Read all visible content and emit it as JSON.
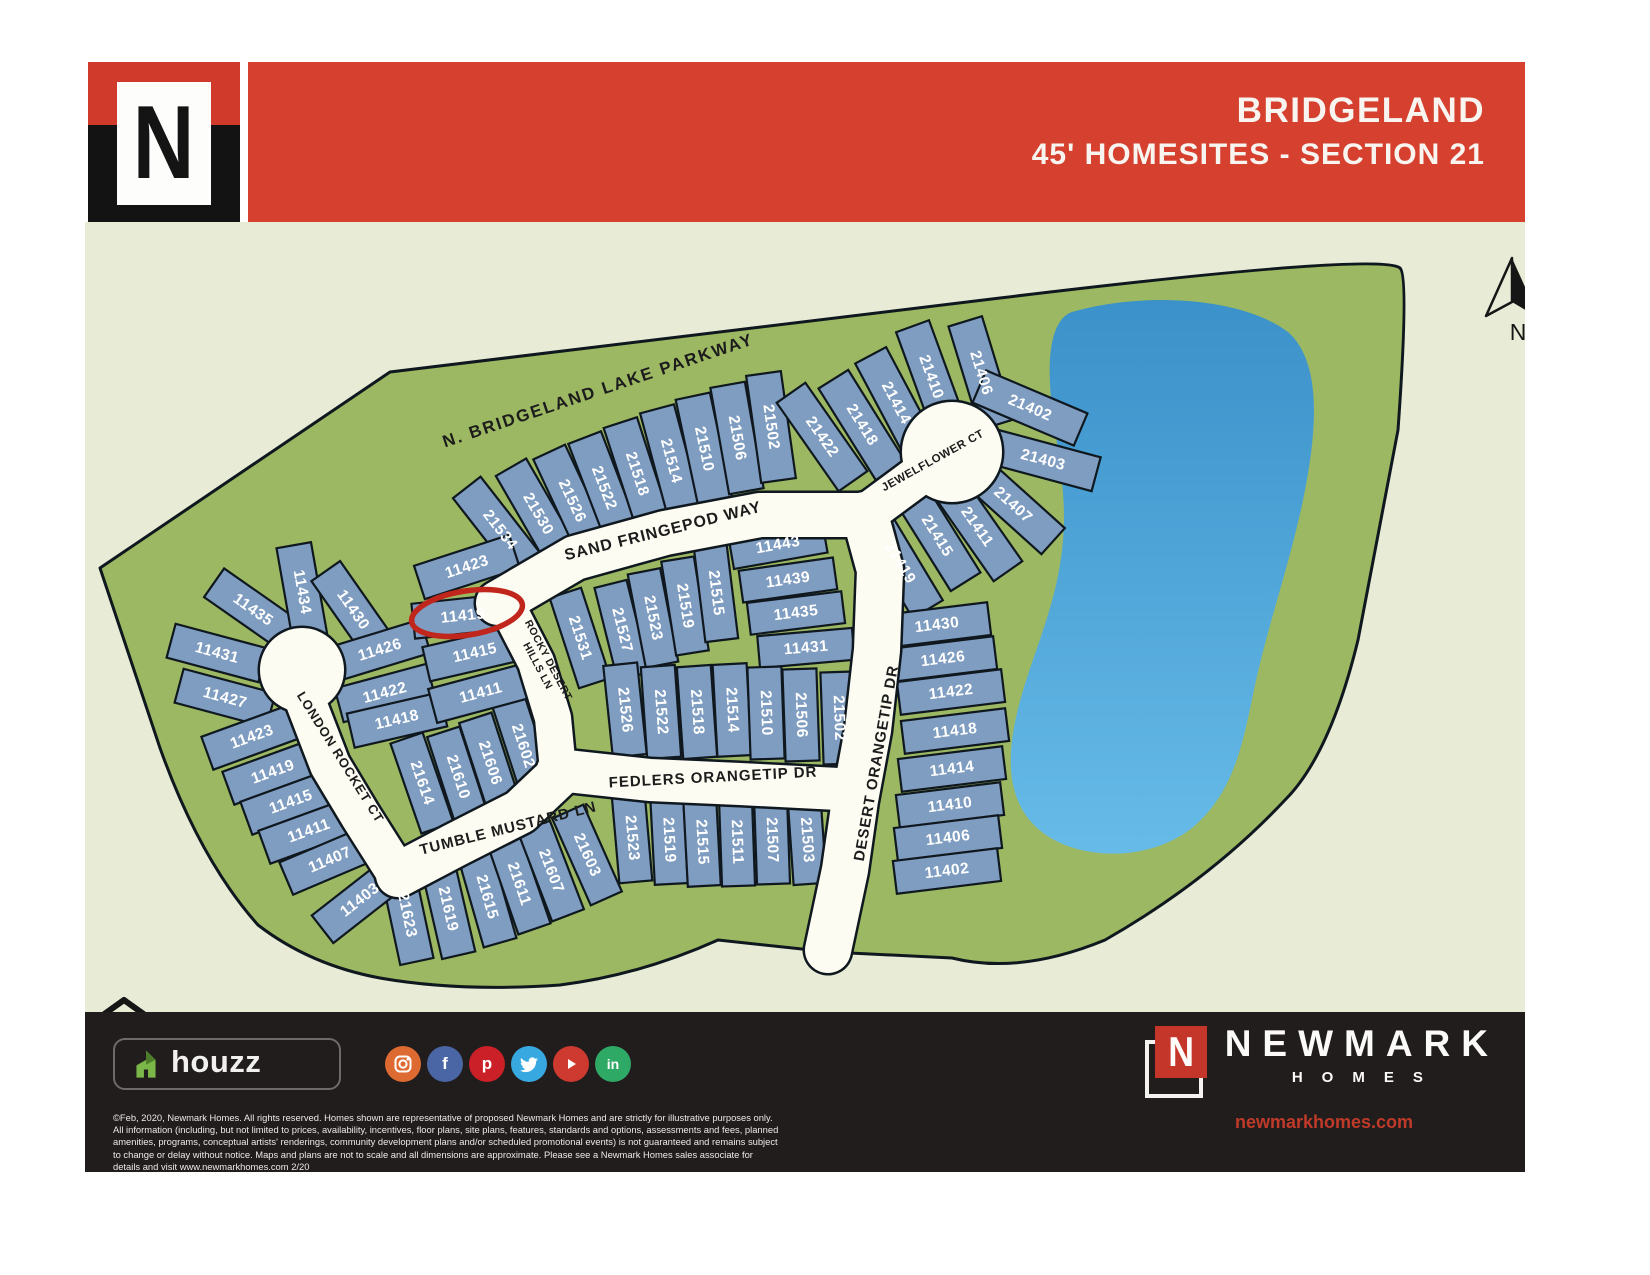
{
  "header": {
    "title_line1": "BRIDGELAND",
    "title_line2": "45' HOMESITES -  SECTION 21",
    "logo_letter": "N",
    "band_color": "#d6402e"
  },
  "map": {
    "colors": {
      "background": "#e8ebd6",
      "land": "#9cb862",
      "lake_top": "#3b91c9",
      "lake_bottom": "#66bbe8",
      "lot": "#7f9dc1",
      "road": "#fcfcf2",
      "outline": "#10181f",
      "street_text": "#1c1c1c",
      "lot_text": "#ffffff",
      "highlight": "#c1261d"
    },
    "land_path": "M 100,568 L 390,372 L 1000,298 Q 1380,252 1400,268 Q 1409,276 1398,430 L 1358,640 Q 1330,755 1285,800 Q 1210,880 1105,940 Q 1020,975 952,958 L 830,952 L 718,940 Q 640,975 560,985 Q 460,992 380,978 Q 310,965 258,925 Q 200,860 160,748 Z",
    "lake_path": "M 1072,312 C 1140,292 1240,296 1288,332 C 1322,362 1318,430 1302,505 C 1287,573 1268,625 1255,685 C 1243,742 1235,792 1192,828 C 1148,863 1072,862 1035,826 C 1002,794 1008,742 1022,694 C 1038,640 1058,600 1063,540 C 1068,482 1052,430 1050,384 C 1048,344 1055,318 1072,312 Z",
    "roads": [
      {
        "name": "sand-fringepod-way",
        "pts": [
          [
            498,
            603
          ],
          [
            575,
            558
          ],
          [
            665,
            533
          ],
          [
            760,
            515
          ],
          [
            865,
            515
          ]
        ],
        "w": 44
      },
      {
        "name": "jewelflower-ct-stem",
        "pts": [
          [
            865,
            515
          ],
          [
            915,
            478
          ],
          [
            940,
            462
          ]
        ],
        "w": 40
      },
      {
        "name": "desert-orangetip-dr",
        "pts": [
          [
            865,
            515
          ],
          [
            880,
            570
          ],
          [
            877,
            650
          ],
          [
            868,
            730
          ],
          [
            855,
            800
          ],
          [
            845,
            870
          ],
          [
            828,
            950
          ]
        ],
        "w": 46
      },
      {
        "name": "fedlers-orangetip-dr",
        "pts": [
          [
            558,
            770
          ],
          [
            650,
            780
          ],
          [
            740,
            784
          ],
          [
            858,
            790
          ]
        ],
        "w": 42
      },
      {
        "name": "rocky-desert-hills-ln",
        "pts": [
          [
            506,
            604
          ],
          [
            536,
            662
          ],
          [
            553,
            718
          ],
          [
            558,
            770
          ]
        ],
        "w": 36
      },
      {
        "name": "tumble-mustard-ln",
        "pts": [
          [
            398,
            875
          ],
          [
            455,
            845
          ],
          [
            520,
            812
          ],
          [
            558,
            776
          ]
        ],
        "w": 44
      },
      {
        "name": "london-rocket-ct-road",
        "pts": [
          [
            305,
            700
          ],
          [
            330,
            765
          ],
          [
            360,
            815
          ],
          [
            398,
            875
          ]
        ],
        "w": 40
      },
      {
        "name": "london-rocket-ct-culdesac",
        "c": [
          302,
          670,
          42
        ]
      },
      {
        "name": "jewelflower-ct-culdesac",
        "c": [
          952,
          452,
          50
        ]
      }
    ],
    "streets": [
      {
        "label": "N. BRIDGELAND LAKE PARKWAY",
        "x": 598,
        "y": 390,
        "rot": -18.5,
        "size": 17,
        "ls": 2
      },
      {
        "label": "SAND FRINGEPOD WAY",
        "x": 663,
        "y": 531,
        "rot": -14,
        "size": 16,
        "ls": 1
      },
      {
        "label": "JEWELFLOWER CT",
        "x": 933,
        "y": 461,
        "rot": -29,
        "size": 11.5,
        "ls": 0.5
      },
      {
        "lines": [
          "ROCKY DESERT",
          "HILLS LN"
        ],
        "x": 545,
        "y": 662,
        "rot": 62,
        "size": 10.5,
        "ls": 0.5
      },
      {
        "label": "LONDON ROCKET CT",
        "x": 341,
        "y": 757,
        "rot": 58,
        "size": 13,
        "ls": 1
      },
      {
        "label": "TUMBLE MUSTARD LN",
        "x": 508,
        "y": 828,
        "rot": -14,
        "size": 15,
        "ls": 1
      },
      {
        "label": "FEDLERS ORANGETIP DR",
        "x": 713,
        "y": 777,
        "rot": -3,
        "size": 15,
        "ls": 1
      },
      {
        "label": "DESERT ORANGETIP DR",
        "x": 876,
        "y": 763,
        "rot": -80,
        "size": 15,
        "ls": 1
      }
    ],
    "lots": [
      [
        "21534",
        500,
        530,
        52
      ],
      [
        "21530",
        538,
        514,
        60
      ],
      [
        "21526",
        572,
        501,
        65
      ],
      [
        "21522",
        604,
        488,
        69
      ],
      [
        "21518",
        637,
        474,
        72
      ],
      [
        "21514",
        671,
        461,
        75
      ],
      [
        "21510",
        704,
        449,
        78
      ],
      [
        "21506",
        737,
        438,
        80
      ],
      [
        "21502",
        771,
        427,
        82
      ],
      [
        "21422",
        822,
        437,
        55
      ],
      [
        "21418",
        862,
        425,
        58
      ],
      [
        "21414",
        896,
        403,
        62
      ],
      [
        "21410",
        931,
        377,
        70
      ],
      [
        "21406",
        981,
        373,
        73
      ],
      [
        "21402",
        1030,
        408,
        23,
        110
      ],
      [
        "21403",
        1043,
        460,
        15,
        110
      ],
      [
        "21407",
        1013,
        505,
        42
      ],
      [
        "21411",
        977,
        527,
        55
      ],
      [
        "21415",
        937,
        536,
        58
      ],
      [
        "21419",
        900,
        563,
        59
      ],
      [
        "11430",
        937,
        625,
        -7,
        105,
        33
      ],
      [
        "11426",
        943,
        659,
        -7,
        105,
        33
      ],
      [
        "11422",
        951,
        692,
        -7,
        105,
        33
      ],
      [
        "11418",
        955,
        731,
        -7,
        105,
        33
      ],
      [
        "11414",
        952,
        769,
        -7,
        105,
        33
      ],
      [
        "11410",
        950,
        805,
        -7,
        105,
        33
      ],
      [
        "11406",
        948,
        838,
        -7,
        105,
        33
      ],
      [
        "11402",
        947,
        871,
        -7,
        105,
        33
      ],
      [
        "21531",
        580,
        638,
        72,
        95,
        33
      ],
      [
        "21527",
        622,
        630,
        76,
        95,
        33
      ],
      [
        "21523",
        653,
        618,
        79,
        95,
        33
      ],
      [
        "21519",
        685,
        606,
        81,
        95,
        33
      ],
      [
        "21515",
        716,
        593,
        83,
        95,
        33
      ],
      [
        "11443",
        778,
        545,
        -10,
        95,
        32
      ],
      [
        "11439",
        788,
        580,
        -8,
        95,
        32
      ],
      [
        "11435",
        796,
        613,
        -7,
        95,
        32
      ],
      [
        "11431",
        806,
        648,
        -5,
        95,
        32
      ],
      [
        "21526",
        625,
        710,
        84,
        92,
        34
      ],
      [
        "21522",
        661,
        712,
        86,
        92,
        34
      ],
      [
        "21518",
        697,
        712,
        86,
        92,
        34
      ],
      [
        "21514",
        732,
        710,
        87,
        92,
        34
      ],
      [
        "21510",
        766,
        713,
        88,
        92,
        34
      ],
      [
        "21506",
        801,
        715,
        88,
        92,
        34
      ],
      [
        "21502",
        839,
        718,
        88,
        92,
        34
      ],
      [
        "21523",
        632,
        838,
        85,
        88,
        33
      ],
      [
        "21519",
        669,
        840,
        87,
        88,
        33
      ],
      [
        "21515",
        702,
        842,
        87,
        88,
        33
      ],
      [
        "21511",
        737,
        842,
        88,
        88,
        33
      ],
      [
        "21507",
        772,
        840,
        88,
        88,
        33
      ],
      [
        "21503",
        807,
        840,
        86,
        88,
        33
      ],
      [
        "21623",
        407,
        915,
        78,
        95,
        34
      ],
      [
        "21619",
        448,
        909,
        77,
        95,
        34
      ],
      [
        "21615",
        487,
        897,
        74,
        95,
        34
      ],
      [
        "21611",
        519,
        884,
        71,
        95,
        34
      ],
      [
        "21607",
        551,
        871,
        69,
        95,
        34
      ],
      [
        "21603",
        587,
        855,
        66,
        95,
        34
      ],
      [
        "11435",
        253,
        610,
        35,
        95
      ],
      [
        "11434",
        302,
        592,
        80,
        95
      ],
      [
        "11430",
        353,
        610,
        55,
        95
      ],
      [
        "11431",
        217,
        653,
        15,
        95
      ],
      [
        "11427",
        225,
        698,
        15,
        95
      ],
      [
        "11423",
        252,
        737,
        -20,
        95
      ],
      [
        "11419",
        273,
        772,
        -20,
        95
      ],
      [
        "11415",
        291,
        802,
        -20,
        95
      ],
      [
        "11411",
        309,
        831,
        -20,
        95
      ],
      [
        "11407",
        330,
        860,
        -23,
        95
      ],
      [
        "11403",
        360,
        900,
        -38,
        95
      ],
      [
        "11426",
        380,
        650,
        -17,
        95
      ],
      [
        "11422",
        385,
        693,
        -15,
        95
      ],
      [
        "11418",
        397,
        720,
        -13,
        95
      ],
      [
        "21614",
        422,
        783,
        71,
        95,
        34
      ],
      [
        "21610",
        458,
        777,
        72,
        95,
        34
      ],
      [
        "21606",
        490,
        763,
        72,
        95,
        34
      ],
      [
        "21602",
        523,
        746,
        72,
        95,
        34
      ],
      [
        "11423",
        467,
        567,
        -18,
        100
      ],
      [
        "11419",
        463,
        616,
        -6,
        100
      ],
      [
        "11415",
        475,
        653,
        -13,
        100
      ],
      [
        "11411",
        481,
        693,
        -15,
        100
      ]
    ],
    "highlight": {
      "lot": "11419",
      "x": 467,
      "y": 613,
      "rx": 56,
      "ry": 22,
      "rot": -9
    },
    "north": {
      "label": "N",
      "x": 1512,
      "y": 258
    },
    "equal_housing": {
      "x": 100,
      "y": 1000
    }
  },
  "footer": {
    "houzz_label": "houzz",
    "social": [
      {
        "name": "instagram-icon",
        "color": "#dd6a31"
      },
      {
        "name": "facebook-icon",
        "color": "#4a66a5",
        "glyph": "f"
      },
      {
        "name": "pinterest-icon",
        "color": "#cb2027",
        "glyph": "p"
      },
      {
        "name": "twitter-icon",
        "color": "#38a8e0"
      },
      {
        "name": "youtube-icon",
        "color": "#cf3a30"
      },
      {
        "name": "linkedin-icon",
        "color": "#2faa66",
        "glyph": "in"
      }
    ],
    "disclaimer": "©Feb, 2020,  Newmark Homes. All rights reserved. Homes shown are representative of proposed Newmark Homes and are strictly for illustrative purposes only. All information (including, but not limited to prices, availability, incentives, floor plans, site plans, features, standards and options, assessments and fees,  planned amenities, programs, conceptual artists' renderings, community development plans and/or scheduled promotional events) is not guaranteed and remains subject to change or delay without notice. Maps and plans are not to scale and all dimensions are approximate. Please see a Newmark Homes sales associate for details and visit www.newmarkhomes.com 2/20",
    "brand_letter": "N",
    "brand_name": "NEWMARK",
    "brand_sub": "HOMES",
    "brand_url": "newmarkhomes.com"
  }
}
